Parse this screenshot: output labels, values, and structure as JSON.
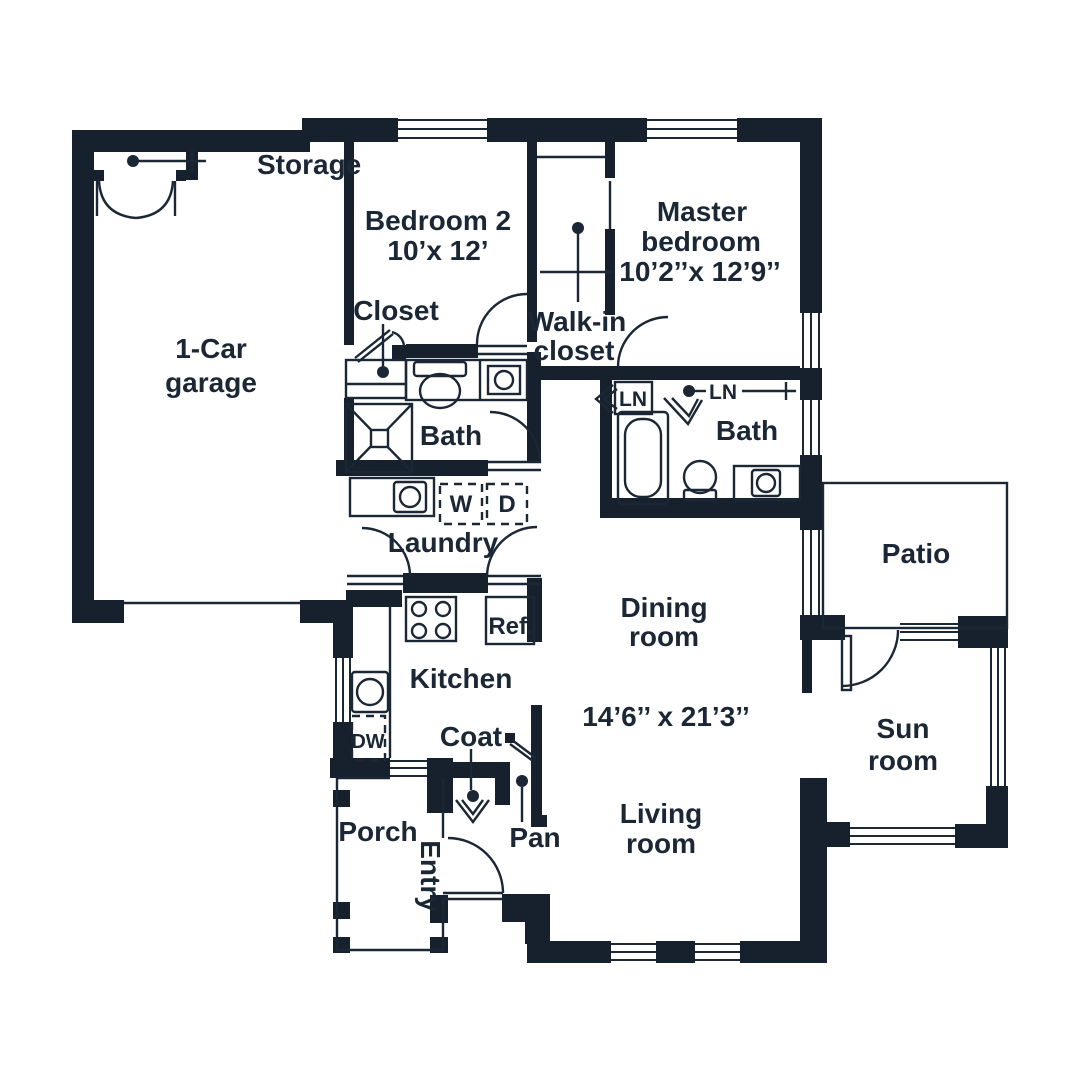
{
  "title": "Floor plan",
  "colors": {
    "wall": "#17212e",
    "line": "#1b2735",
    "text": "#1b2735",
    "background": "#ffffff"
  },
  "rooms": {
    "storage": {
      "label": "Storage"
    },
    "garage": {
      "line1": "1-Car",
      "line2": "garage"
    },
    "bedroom2": {
      "name": "Bedroom 2",
      "dims": "10’x 12’"
    },
    "closet": {
      "label": "Closet"
    },
    "walk_in_closet": {
      "line1": "Walk-in",
      "line2": "closet"
    },
    "master_bedroom": {
      "line1": "Master",
      "line2": "bedroom",
      "dims": "10’2’’x 12’9’’"
    },
    "hall_bath": {
      "label": "Bath"
    },
    "master_bath": {
      "label": "Bath"
    },
    "linen_left": {
      "label": "LN"
    },
    "linen_right": {
      "label": "LN"
    },
    "laundry": {
      "label": "Laundry",
      "washer": "W",
      "dryer": "D"
    },
    "kitchen": {
      "label": "Kitchen",
      "fridge": "Ref.",
      "dishwasher": "DW"
    },
    "coat": {
      "label": "Coat"
    },
    "pantry": {
      "label": "Pan"
    },
    "dining": {
      "line1": "Dining",
      "line2": "room"
    },
    "living": {
      "line1": "Living",
      "line2": "room",
      "dims": "14’6’’ x 21’3’’"
    },
    "porch": {
      "label": "Porch"
    },
    "entry": {
      "label": "Entry"
    },
    "patio": {
      "label": "Patio"
    },
    "sunroom": {
      "line1": "Sun",
      "line2": "room"
    }
  }
}
